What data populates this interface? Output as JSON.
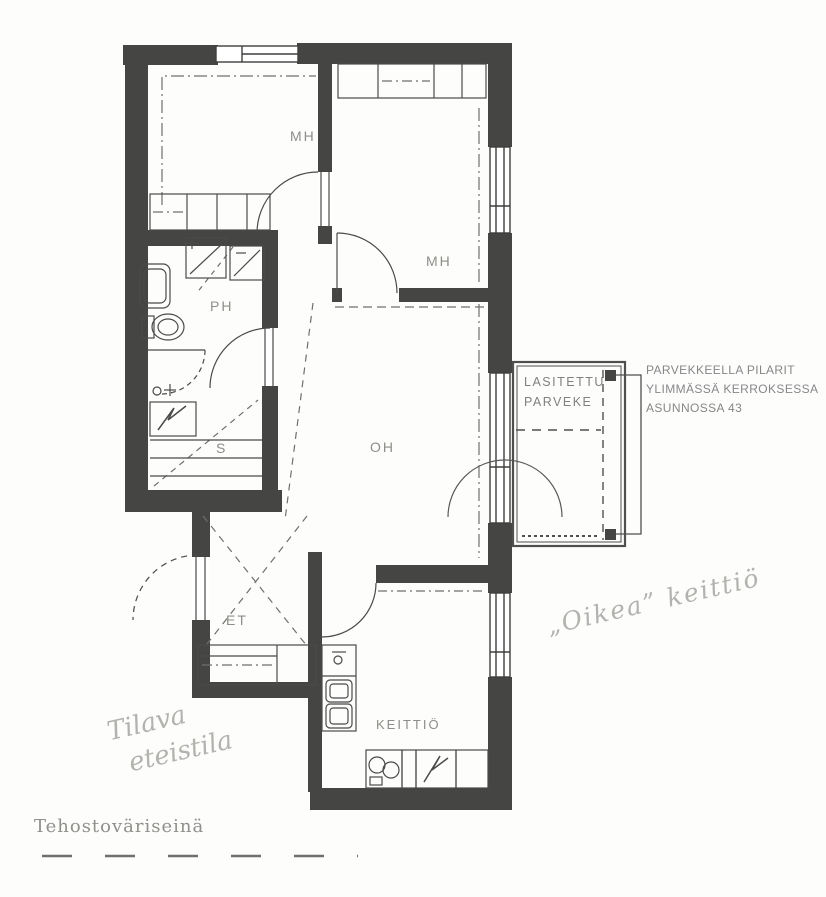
{
  "plan": {
    "rooms": {
      "mh1": "MH",
      "mh2": "MH",
      "ph": "PH",
      "sauna": "S",
      "et": "ET",
      "oh": "OH",
      "keittio": "KEITTIÖ"
    },
    "balcony_label": {
      "line1": "LASITETTU",
      "line2": "PARVEKE"
    }
  },
  "annotations": {
    "balcony_note": [
      "PARVEKKEELLA PILARIT",
      "YLIMMÄSSÄ KERROKSESSA",
      "ASUNNOSSA 43"
    ],
    "kitchen_note": "„Oikea” keittiö",
    "hallway_note": [
      "Tilava",
      "eteistila"
    ],
    "accent_wall_note": "Tehostoväriseinä"
  },
  "colors": {
    "wall": "#454543",
    "line": "#4a4a48",
    "room_label": "#8d8d89",
    "handwriting": "#b2b2ae"
  }
}
